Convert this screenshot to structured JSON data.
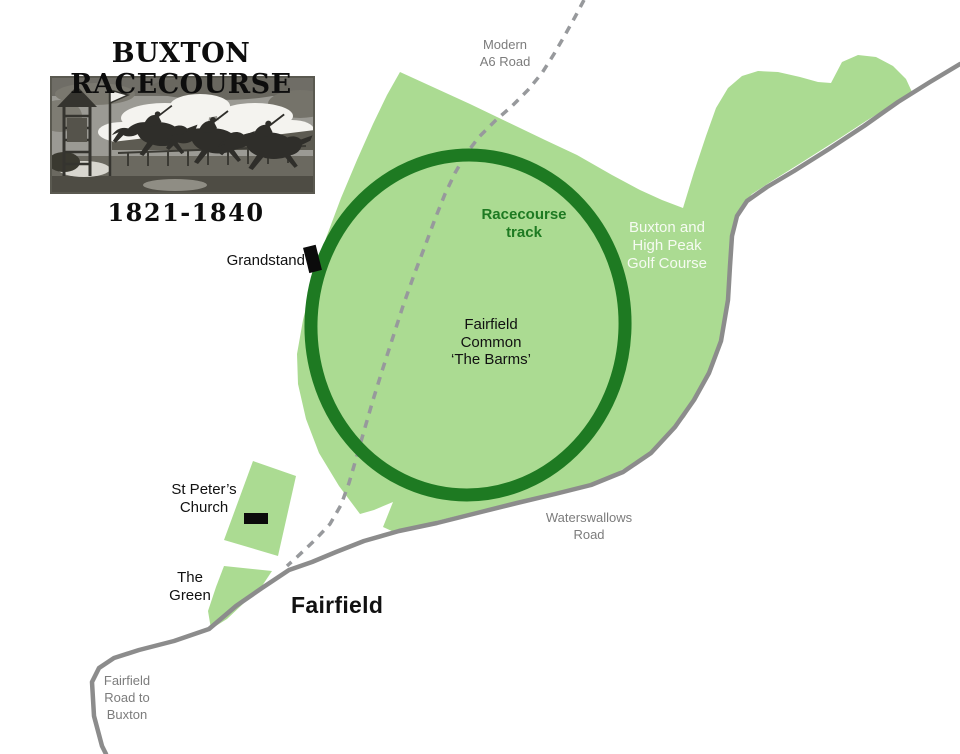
{
  "title": "BUXTON RACECOURSE",
  "years": "1821-1840",
  "labels": {
    "modern_a6_road": "Modern\nA6 Road",
    "racecourse_track": "Racecourse\ntrack",
    "golf_course": "Buxton and\nHigh Peak\nGolf Course",
    "fairfield_common": "Fairfield\nCommon\n‘The Barms’",
    "grandstand": "Grandstand",
    "st_peters_church": "St Peter’s\nChurch",
    "waterswallows_road": "Waterswallows\nRoad",
    "the_green": "The\nGreen",
    "fairfield": "Fairfield",
    "fairfield_road_to_buxton": "Fairfield\nRoad to\nBuxton"
  },
  "colors": {
    "light_green": "#abdb92",
    "track_green": "#1e7a22",
    "road_gray": "#8c8c8c",
    "dash_gray": "#97999c",
    "label_gray": "#7c7c7c",
    "ink": "#111111"
  }
}
